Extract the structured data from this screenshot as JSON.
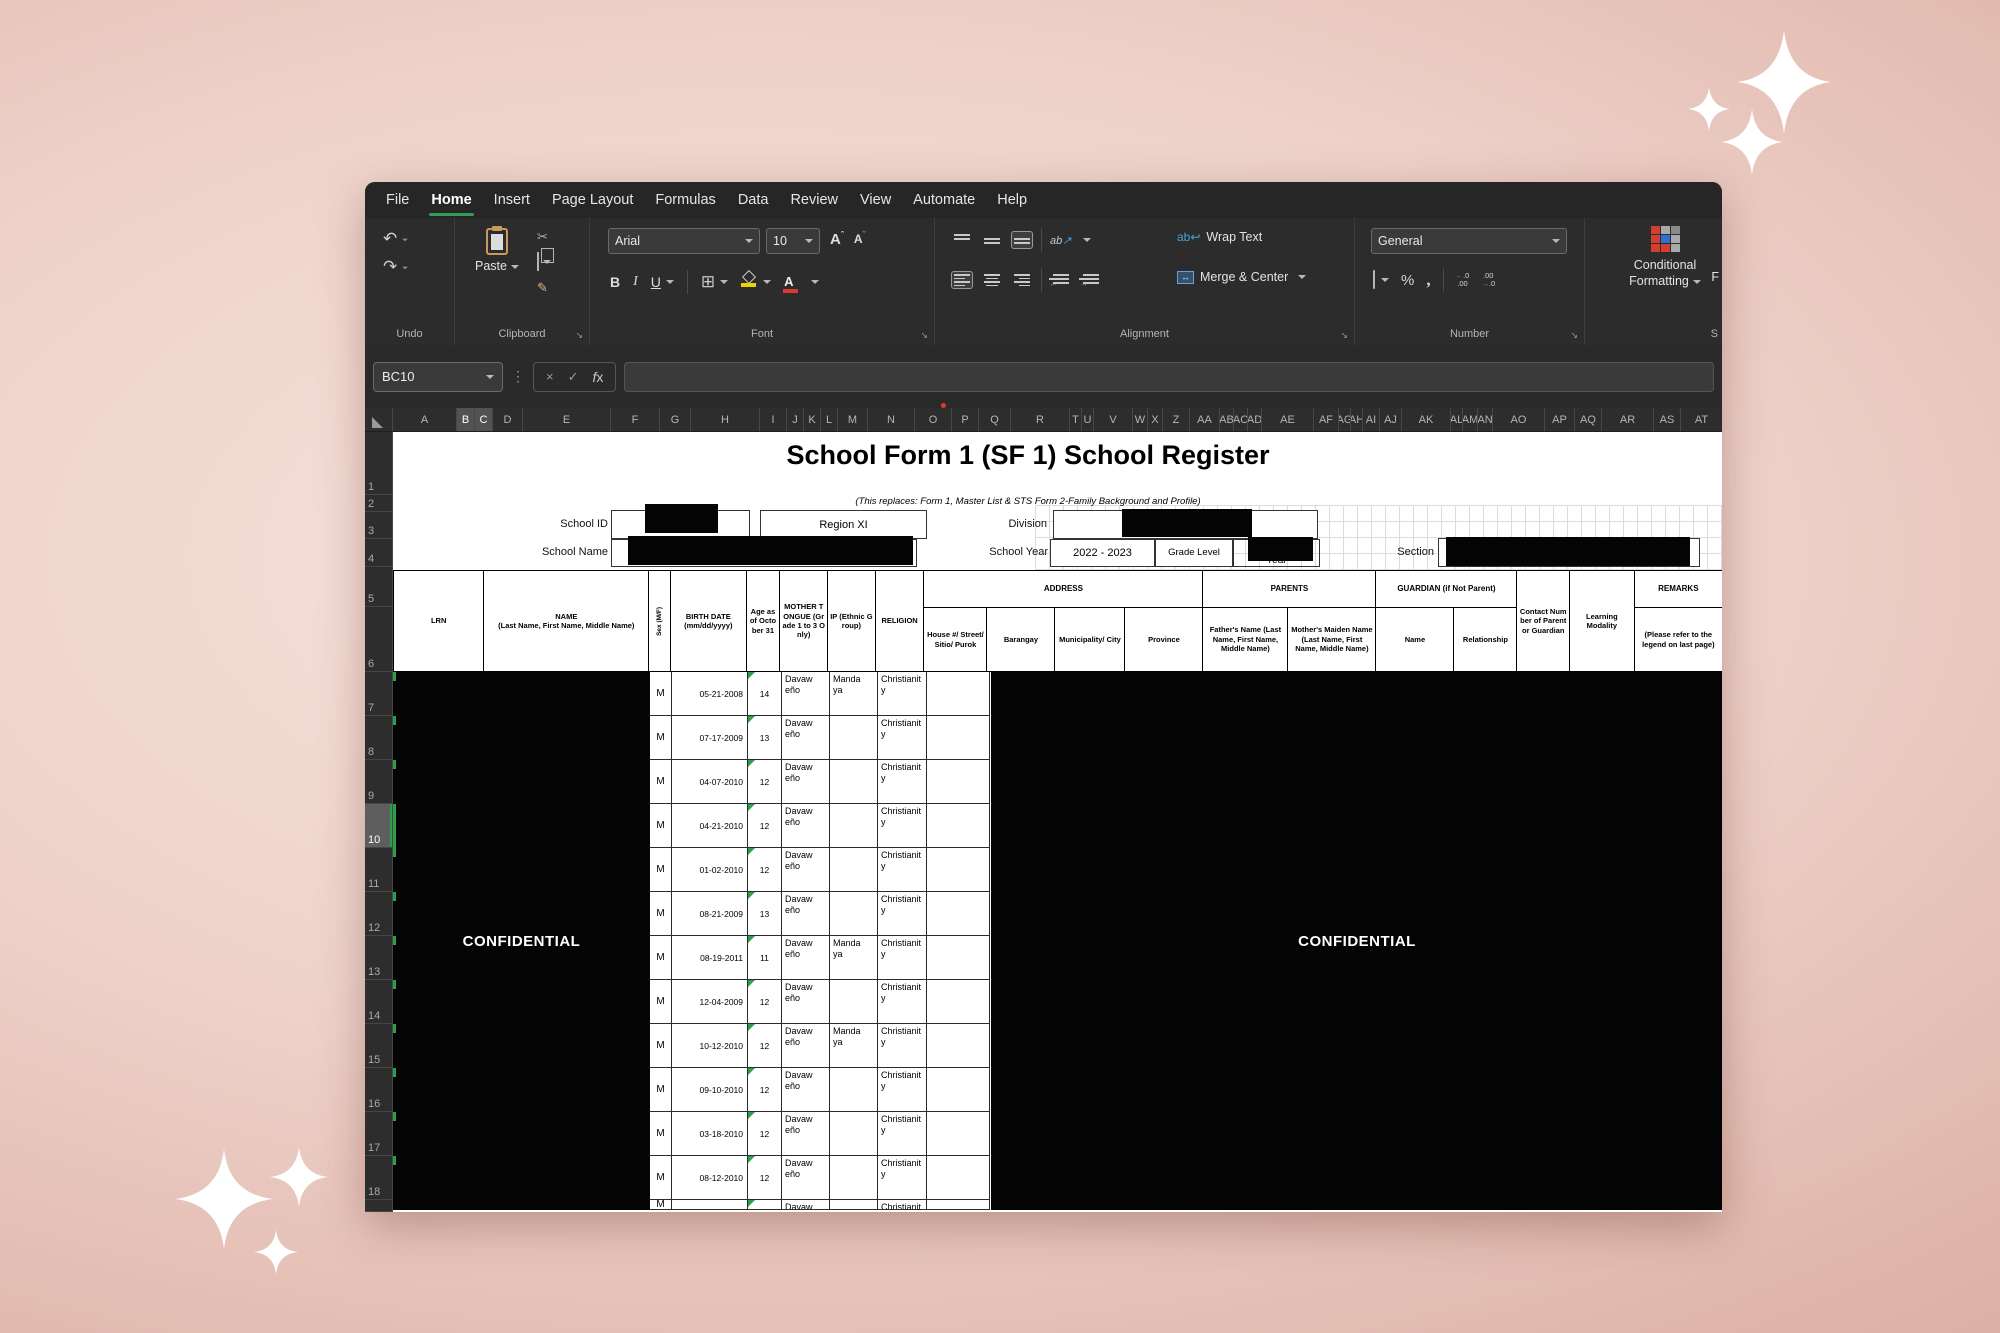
{
  "menu": {
    "tabs": [
      "File",
      "Home",
      "Insert",
      "Page Layout",
      "Formulas",
      "Data",
      "Review",
      "View",
      "Automate",
      "Help"
    ],
    "active": "Home"
  },
  "ribbon": {
    "groups": {
      "undo": "Undo",
      "clipboard": "Clipboard",
      "font": "Font",
      "alignment": "Alignment",
      "number": "Number",
      "styles_clipped": "S"
    },
    "paste": "Paste",
    "font_name": "Arial",
    "font_size": "10",
    "bold": "B",
    "italic": "I",
    "underline": "U",
    "orientation": "ab",
    "wrap_text": "Wrap Text",
    "merge_center": "Merge & Center",
    "number_format": "General",
    "percent": "%",
    "comma": ",",
    "conditional_l1": "Conditional",
    "conditional_l2": "Formatting",
    "clipped_button": "F"
  },
  "formula_bar": {
    "name_box": "BC10",
    "fx": "fx",
    "formula": ""
  },
  "grid": {
    "columns": [
      [
        "A",
        64
      ],
      [
        "B",
        18
      ],
      [
        "C",
        18
      ],
      [
        "D",
        30
      ],
      [
        "E",
        88
      ],
      [
        "F",
        49
      ],
      [
        "G",
        31
      ],
      [
        "H",
        69
      ],
      [
        "I",
        27
      ],
      [
        "J",
        17
      ],
      [
        "K",
        17
      ],
      [
        "L",
        17
      ],
      [
        "M",
        30
      ],
      [
        "N",
        47
      ],
      [
        "O",
        37
      ],
      [
        "P",
        27
      ],
      [
        "Q",
        32
      ],
      [
        "R",
        59
      ],
      [
        "T",
        12
      ],
      [
        "U",
        12
      ],
      [
        "V",
        39
      ],
      [
        "W",
        15
      ],
      [
        "X",
        15
      ],
      [
        "Z",
        27
      ],
      [
        "AA",
        30
      ],
      [
        "AB",
        14
      ],
      [
        "AC",
        14
      ],
      [
        "AD",
        14
      ],
      [
        "AE",
        52
      ],
      [
        "AF",
        25
      ],
      [
        "AG",
        12
      ],
      [
        "AH",
        12
      ],
      [
        "AI",
        17
      ],
      [
        "AJ",
        22
      ],
      [
        "AK",
        49
      ],
      [
        "AL",
        12
      ],
      [
        "AM",
        15
      ],
      [
        "AN",
        15
      ],
      [
        "AO",
        52
      ],
      [
        "AP",
        30
      ],
      [
        "AQ",
        27
      ],
      [
        "AR",
        52
      ],
      [
        "AS",
        27
      ],
      [
        "AT",
        42
      ]
    ],
    "highlighted_columns": [
      "B",
      "C"
    ],
    "rows": [
      "1",
      "2",
      "3",
      "4",
      "5",
      "6",
      "7",
      "8",
      "9",
      "10",
      "11",
      "12",
      "13",
      "14",
      "15",
      "16",
      "17",
      "18"
    ],
    "active_row": "10"
  },
  "form": {
    "title": "School Form 1 (SF 1) School Register",
    "subtitle": "(This replaces: Form 1, Master List & STS Form 2-Family Background and Profile)",
    "school_id_label": "School ID",
    "region_value": "Region XI",
    "division_label": "Division",
    "school_name_label": "School Name",
    "school_year_label": "School Year",
    "school_year_value": "2022 - 2023",
    "grade_level_label": "Grade Level",
    "year_peek": "Year",
    "section_label": "Section",
    "confidential_left": "CONFIDENTIAL",
    "confidential_right": "CONFIDENTIAL"
  },
  "table": {
    "headers": {
      "lrn": "LRN",
      "name_l1": "NAME",
      "name_l2": "(Last Name, First Name, Middle Name)",
      "sex": "Sex (M/F)",
      "birth": "BIRTH DATE (mm/dd/yyyy)",
      "age": "Age as of October 31",
      "mother_tongue": "MOTHER TONGUE (Grade 1 to 3 Only)",
      "ip": "IP (Ethnic Group)",
      "religion": "RELIGION",
      "address_group": "ADDRESS",
      "house": "House #/ Street/ Sitio/ Purok",
      "barangay": "Barangay",
      "municipality": "Municipality/ City",
      "province": "Province",
      "parents_group": "PARENTS",
      "father": "Father's Name (Last Name, First Name, Middle Name)",
      "mother": "Mother's Maiden Name (Last Name, First Name, Middle Name)",
      "guardian_group": "GUARDIAN (if Not Parent)",
      "guardian_name": "Name",
      "relationship": "Relationship",
      "contact": "Contact Number of Parent or Guardian",
      "modality": "Learning Modality",
      "remarks": "REMARKS",
      "remarks_note": "(Please refer to the legend on last page)"
    },
    "rows": [
      {
        "sex": "M",
        "birth_date": "05-21-2008",
        "age": "14",
        "mother_tongue": "Davaweño",
        "ip": "Mandaya",
        "religion": "Christianity"
      },
      {
        "sex": "M",
        "birth_date": "07-17-2009",
        "age": "13",
        "mother_tongue": "Davaweño",
        "ip": "",
        "religion": "Christianity"
      },
      {
        "sex": "M",
        "birth_date": "04-07-2010",
        "age": "12",
        "mother_tongue": "Davaweño",
        "ip": "",
        "religion": "Christianity"
      },
      {
        "sex": "M",
        "birth_date": "04-21-2010",
        "age": "12",
        "mother_tongue": "Davaweño",
        "ip": "",
        "religion": "Christianity"
      },
      {
        "sex": "M",
        "birth_date": "01-02-2010",
        "age": "12",
        "mother_tongue": "Davaweño",
        "ip": "",
        "religion": "Christianity"
      },
      {
        "sex": "M",
        "birth_date": "08-21-2009",
        "age": "13",
        "mother_tongue": "Davaweño",
        "ip": "",
        "religion": "Christianity"
      },
      {
        "sex": "M",
        "birth_date": "08-19-2011",
        "age": "11",
        "mother_tongue": "Davaweño",
        "ip": "Mandaya",
        "religion": "Christianity"
      },
      {
        "sex": "M",
        "birth_date": "12-04-2009",
        "age": "12",
        "mother_tongue": "Davaweño",
        "ip": "",
        "religion": "Christianity"
      },
      {
        "sex": "M",
        "birth_date": "10-12-2010",
        "age": "12",
        "mother_tongue": "Davaweño",
        "ip": "Mandaya",
        "religion": "Christianity"
      },
      {
        "sex": "M",
        "birth_date": "09-10-2010",
        "age": "12",
        "mother_tongue": "Davaweño",
        "ip": "",
        "religion": "Christianity"
      },
      {
        "sex": "M",
        "birth_date": "03-18-2010",
        "age": "12",
        "mother_tongue": "Davaweño",
        "ip": "",
        "religion": "Christianity"
      },
      {
        "sex": "M",
        "birth_date": "08-12-2010",
        "age": "12",
        "mother_tongue": "Davaweño",
        "ip": "",
        "religion": "Christianity"
      }
    ],
    "partial_row": {
      "sex": "M",
      "birth_date": "",
      "age": "",
      "mother_tongue": "Davaweño",
      "ip": "",
      "religion": "Christianity"
    }
  },
  "colors": {
    "accent_green": "#2f9e4a",
    "redaction": "#040404",
    "confidential_text": "#ffffff",
    "ribbon_red": "#d23f31",
    "ribbon_blue": "#2f6fd8",
    "fill_yellow": "#e8d800",
    "font_color_red": "#d83b2d",
    "background_pink": "#e8c7bf"
  },
  "icons": {
    "select_all": "corner-triangle",
    "dialog_launcher": "↘",
    "undo": "↶",
    "redo": "↷",
    "scissors": "✂",
    "format_painter": "✎",
    "dropdown": "chevron-down",
    "cancel": "×",
    "enter": "✓",
    "comment_flag": "red-dot",
    "sparkle": "four-point-star"
  }
}
